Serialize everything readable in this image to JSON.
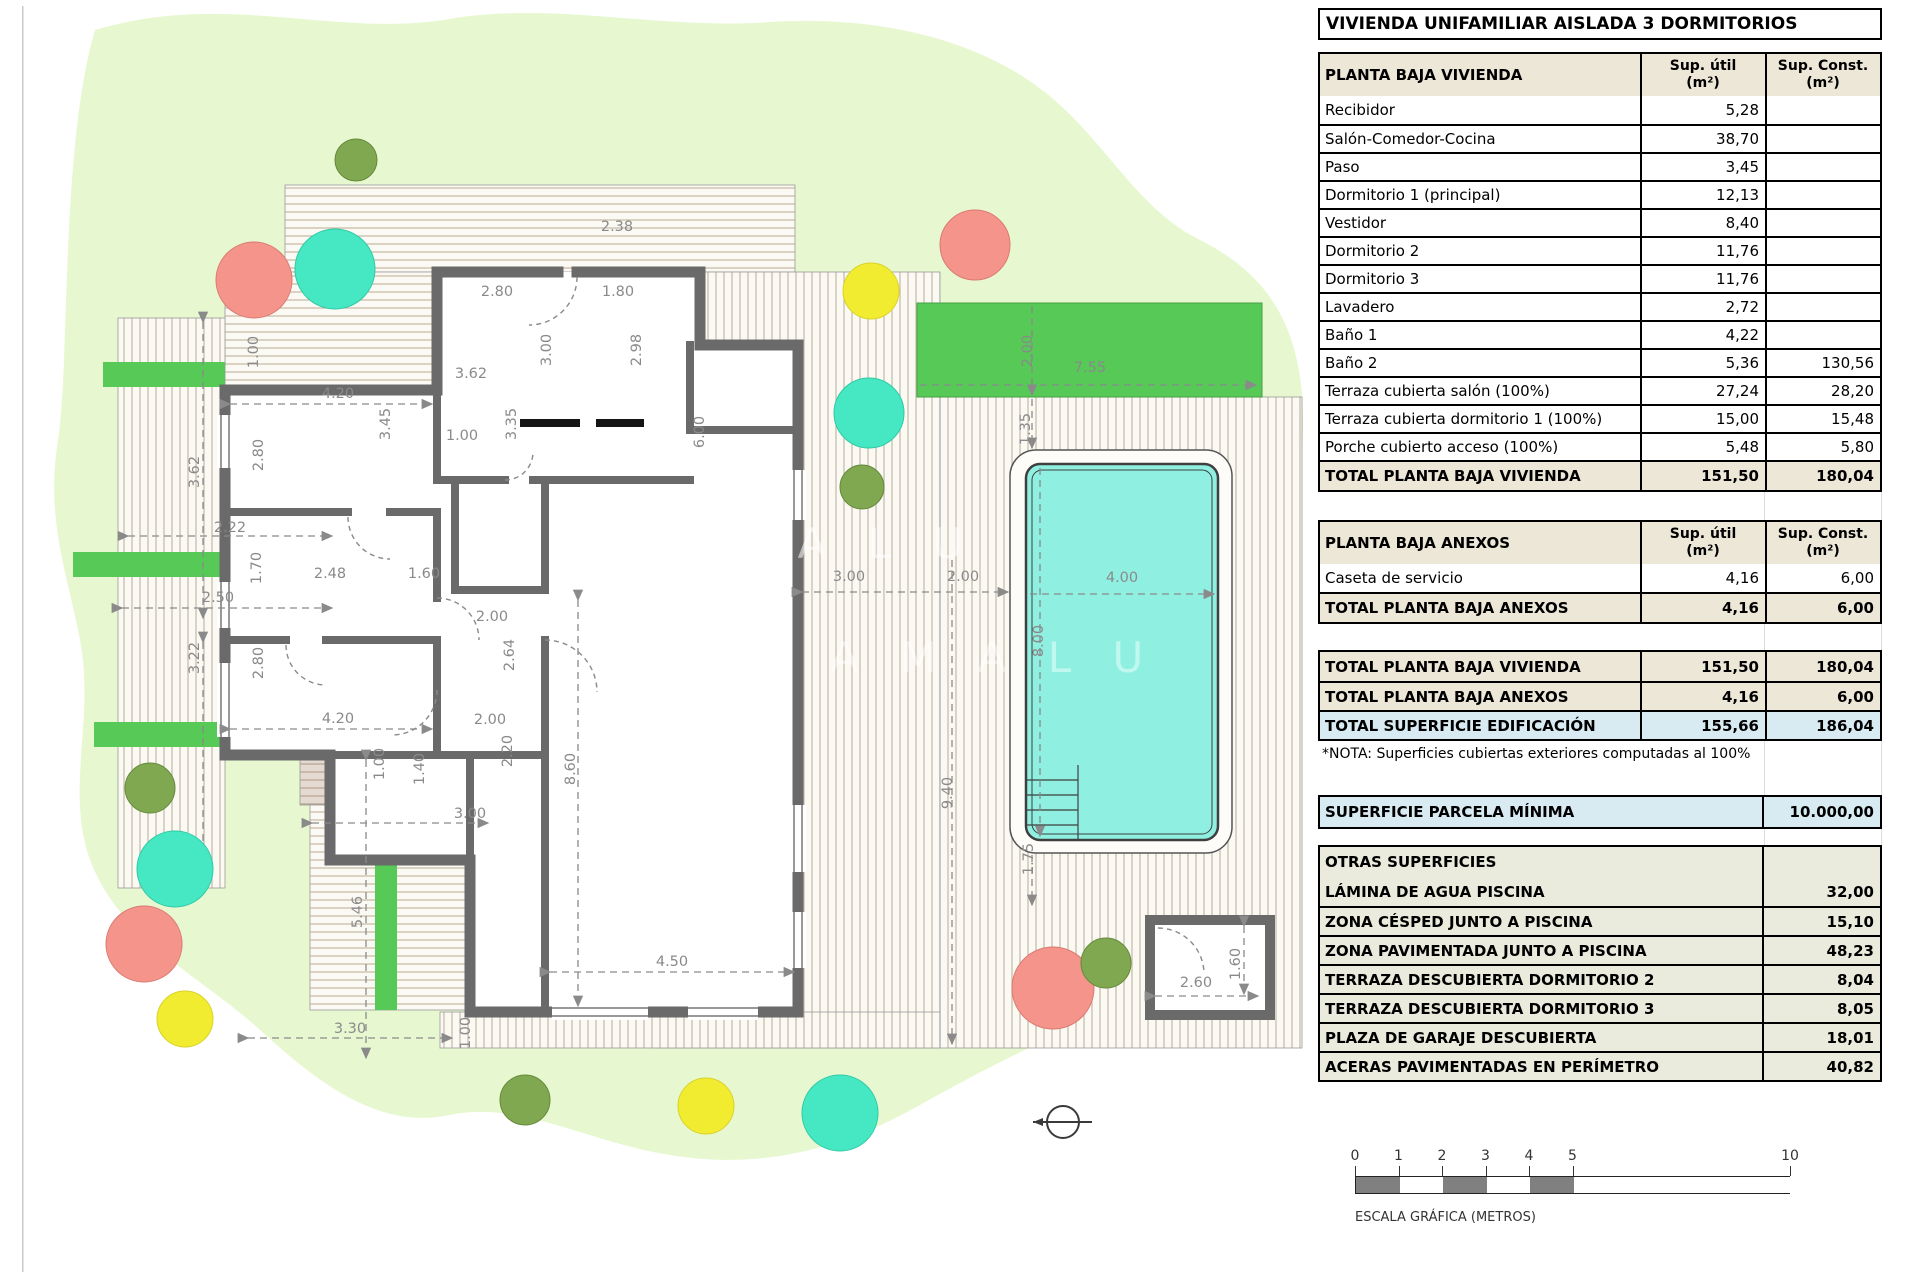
{
  "title": "VIVIENDA UNIFAMILIAR AISLADA 3 DORMITORIOS",
  "tables": {
    "vivienda": {
      "header": "PLANTA BAJA VIVIENDA",
      "col1": {
        "l1": "Sup. útil",
        "l2": "(m²)"
      },
      "col2": {
        "l1": "Sup. Const.",
        "l2": "(m²)"
      },
      "rows": [
        [
          "Recibidor",
          "5,28",
          ""
        ],
        [
          "Salón-Comedor-Cocina",
          "38,70",
          ""
        ],
        [
          "Paso",
          "3,45",
          ""
        ],
        [
          "Dormitorio 1 (principal)",
          "12,13",
          ""
        ],
        [
          "Vestidor",
          "8,40",
          ""
        ],
        [
          "Dormitorio 2",
          "11,76",
          ""
        ],
        [
          "Dormitorio 3",
          "11,76",
          ""
        ],
        [
          "Lavadero",
          "2,72",
          ""
        ],
        [
          "Baño 1",
          "4,22",
          ""
        ],
        [
          "Baño 2",
          "5,36",
          "130,56"
        ],
        [
          "Terraza cubierta salón (100%)",
          "27,24",
          "28,20"
        ],
        [
          "Terraza cubierta dormitorio 1 (100%)",
          "15,00",
          "15,48"
        ],
        [
          "Porche cubierto acceso (100%)",
          "5,48",
          "5,80"
        ]
      ],
      "total": [
        "TOTAL PLANTA BAJA VIVIENDA",
        "151,50",
        "180,04"
      ]
    },
    "anexos": {
      "header": "PLANTA BAJA ANEXOS",
      "col1": {
        "l1": "Sup. útil",
        "l2": "(m²)"
      },
      "col2": {
        "l1": "Sup. Const.",
        "l2": "(m²)"
      },
      "rows": [
        [
          "Caseta de servicio",
          "4,16",
          "6,00"
        ]
      ],
      "total": [
        "TOTAL PLANTA BAJA ANEXOS",
        "4,16",
        "6,00"
      ]
    },
    "totales": {
      "rows": [
        [
          "TOTAL PLANTA BAJA VIVIENDA",
          "151,50",
          "180,04",
          "bgbeige"
        ],
        [
          "TOTAL PLANTA BAJA ANEXOS",
          "4,16",
          "6,00",
          "bgbeige"
        ],
        [
          "TOTAL SUPERFICIE EDIFICACIÓN",
          "155,66",
          "186,04",
          "bgblue"
        ]
      ],
      "nota": "*NOTA: Superficies cubiertas exteriores computadas al 100%"
    },
    "parcela": {
      "label": "SUPERFICIE PARCELA MÍNIMA",
      "value": "10.000,00"
    },
    "otras": {
      "header": "OTRAS SUPERFICIES",
      "rows": [
        [
          "LÁMINA DE AGUA PISCINA",
          "32,00"
        ],
        [
          "ZONA CÉSPED JUNTO A PISCINA",
          "15,10"
        ],
        [
          "ZONA PAVIMENTADA JUNTO A PISCINA",
          "48,23"
        ],
        [
          "TERRAZA DESCUBIERTA DORMITORIO 2",
          "8,04"
        ],
        [
          "TERRAZA DESCUBIERTA DORMITORIO 3",
          "8,05"
        ],
        [
          "PLAZA DE GARAJE DESCUBIERTA",
          "18,01"
        ],
        [
          "ACERAS PAVIMENTADAS EN PERÍMETRO",
          "40,82"
        ]
      ]
    }
  },
  "scale": {
    "caption": "ESCALA GRÁFICA (METROS)",
    "ticks": [
      [
        "0",
        0
      ],
      [
        "1",
        43.5
      ],
      [
        "2",
        87
      ],
      [
        "3",
        130.5
      ],
      [
        "4",
        174
      ],
      [
        "5",
        217.5
      ],
      [
        "10",
        435
      ]
    ],
    "segments": [
      [
        0,
        43.5,
        1
      ],
      [
        43.5,
        87,
        0
      ],
      [
        87,
        130.5,
        1
      ],
      [
        130.5,
        174,
        0
      ],
      [
        174,
        217.5,
        1
      ],
      [
        217.5,
        435,
        0
      ]
    ]
  },
  "plan": {
    "watermark": "A M A L U",
    "dims": [
      [
        "2.38",
        617,
        231,
        0
      ],
      [
        "2.80",
        497,
        296,
        0
      ],
      [
        "1.80",
        618,
        296,
        0
      ],
      [
        "3.00",
        551,
        350,
        1
      ],
      [
        "2.98",
        641,
        350,
        1
      ],
      [
        "1.00",
        258,
        352,
        1
      ],
      [
        "3.62",
        471,
        378,
        0
      ],
      [
        "4.20",
        338,
        398,
        0
      ],
      [
        "3.45",
        390,
        424,
        1
      ],
      [
        "3.35",
        516,
        424,
        1
      ],
      [
        "1.00",
        462,
        440,
        0
      ],
      [
        "6.00",
        704,
        432,
        1
      ],
      [
        "2.80",
        263,
        455,
        1
      ],
      [
        "3.62",
        199,
        472,
        1
      ],
      [
        "2.22",
        230,
        532,
        0
      ],
      [
        "1.70",
        261,
        568,
        1
      ],
      [
        "2.48",
        330,
        578,
        0
      ],
      [
        "1.60",
        424,
        578,
        0
      ],
      [
        "2.50",
        218,
        602,
        0
      ],
      [
        "3.22",
        199,
        658,
        1
      ],
      [
        "2.80",
        263,
        663,
        1
      ],
      [
        "2.00",
        492,
        621,
        0
      ],
      [
        "2.64",
        514,
        655,
        1
      ],
      [
        "4.20",
        338,
        723,
        0
      ],
      [
        "2.00",
        490,
        724,
        0
      ],
      [
        "2.20",
        512,
        751,
        1
      ],
      [
        "1.40",
        424,
        769,
        1
      ],
      [
        "1.00",
        384,
        764,
        1
      ],
      [
        "8.60",
        575,
        769,
        1
      ],
      [
        "3.00",
        470,
        818,
        0
      ],
      [
        "5.46",
        362,
        912,
        1
      ],
      [
        "3.30",
        350,
        1033,
        0
      ],
      [
        "1.00",
        470,
        1033,
        1
      ],
      [
        "4.50",
        672,
        966,
        0
      ],
      [
        "9.40",
        952,
        793,
        1
      ],
      [
        "3.00",
        849,
        581,
        0
      ],
      [
        "2.00",
        963,
        581,
        0
      ],
      [
        "7.55",
        1090,
        372,
        0
      ],
      [
        "2.00",
        1032,
        351,
        1
      ],
      [
        "1.35",
        1030,
        429,
        1
      ],
      [
        "4.00",
        1122,
        582,
        0
      ],
      [
        "8.00",
        1043,
        641,
        1
      ],
      [
        "1.75",
        1033,
        859,
        1
      ],
      [
        "2.60",
        1196,
        987,
        0
      ],
      [
        "1.60",
        1240,
        964,
        1
      ]
    ],
    "trees": [
      [
        356,
        160,
        21,
        "olive"
      ],
      [
        254,
        280,
        38,
        "salmon"
      ],
      [
        335,
        269,
        40,
        "turquoise"
      ],
      [
        975,
        245,
        35,
        "salmon"
      ],
      [
        871,
        291,
        28,
        "yellow"
      ],
      [
        869,
        413,
        35,
        "turquoise"
      ],
      [
        862,
        487,
        22,
        "olive"
      ],
      [
        150,
        788,
        25,
        "olive"
      ],
      [
        175,
        869,
        38,
        "turquoise"
      ],
      [
        144,
        944,
        38,
        "salmon"
      ],
      [
        185,
        1019,
        28,
        "yellow"
      ],
      [
        1053,
        988,
        41,
        "salmon"
      ],
      [
        1106,
        963,
        25,
        "olive"
      ],
      [
        525,
        1100,
        25,
        "olive"
      ],
      [
        706,
        1106,
        28,
        "yellow"
      ],
      [
        840,
        1113,
        38,
        "turquoise"
      ]
    ],
    "colors": {
      "lawn": "#E7F8D0",
      "grass": "#56C957",
      "pool_water": "#8FF0E1",
      "wall": "#6A6A6A",
      "beige_header": "#EDE7D8",
      "blue_highlight": "#D8EAF2",
      "otras_bg": "#EAEBDC",
      "salmon": "#F4948A",
      "turquoise": "#45E8C2",
      "yellow": "#F2EC30",
      "olive": "#7FA850",
      "dim_text": "#8A8A8A",
      "scale_fill": "#808080"
    }
  }
}
